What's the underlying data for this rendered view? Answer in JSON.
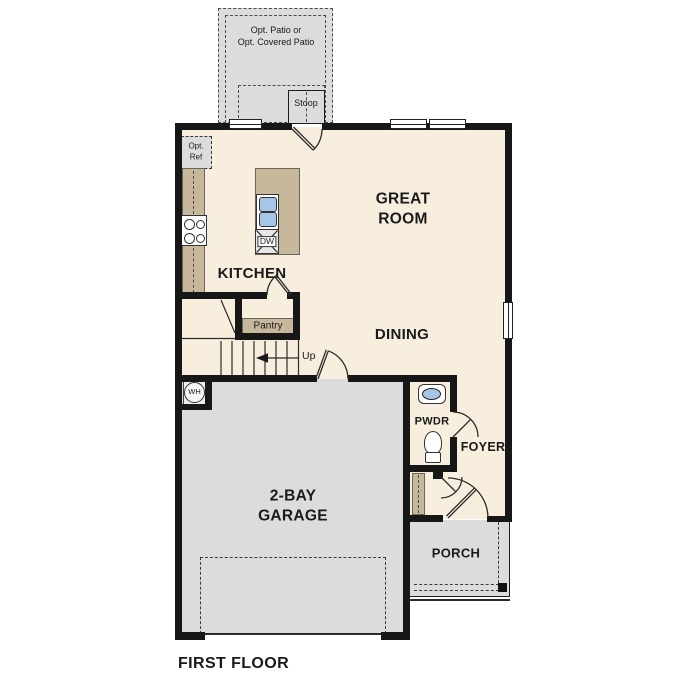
{
  "plan_title": "FIRST FLOOR",
  "rooms": {
    "great_room": "GREAT\nROOM",
    "dining": "DINING",
    "kitchen": "KITCHEN",
    "garage": "2-BAY\nGARAGE",
    "powder_room": "PWDR",
    "foyer": "FOYER",
    "porch": "PORCH",
    "pantry": "Pantry",
    "stoop": "Stoop",
    "optional_patio": "Opt. Patio or\nOpt. Covered Patio"
  },
  "annotations": {
    "stairs_direction": "Up",
    "optional_refrigerator": "Opt.\nRef",
    "dishwasher": "DW",
    "water_heater": "WH"
  },
  "colors": {
    "wall": "#171717",
    "floor": "#f7eedd",
    "concrete": "#dcdcdc",
    "counter": "#c8b89b",
    "fixture_blue": "#a5c6e4",
    "line": "#2b2b2b"
  }
}
